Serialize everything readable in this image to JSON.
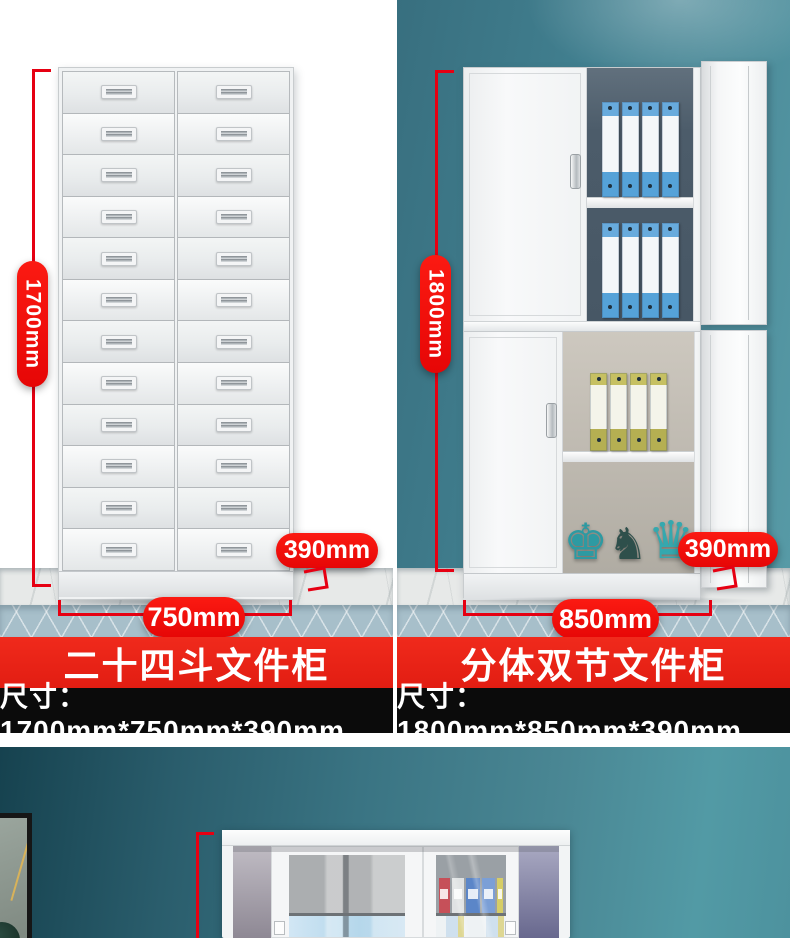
{
  "colors": {
    "accent_red": "#f2100e",
    "dimension_line_red": "#e60012",
    "banner_red": "#e8261a",
    "banner_black": "#0b0b0b",
    "wall_teal": "#417f8f",
    "floor_marble": "#e7e9e8",
    "carpet_blue": "#a7bfca",
    "cabinet_white": "#f5f6f7",
    "binder_blue": "#5fa8db",
    "binder_olive": "#c5bf63"
  },
  "products": [
    {
      "title": "二十四斗文件柜",
      "size_text": "尺寸：1700mm*750mm*390mm",
      "height_label": "1700mm",
      "width_label": "750mm",
      "depth_label": "390mm",
      "drawer_columns": 2,
      "drawer_rows": 12
    },
    {
      "title": "分体双节文件柜",
      "size_text": "尺寸：1800mm*850mm*390mm",
      "height_label": "1800mm",
      "width_label": "850mm",
      "depth_label": "390mm",
      "shelves": [
        {
          "binder_count": 4,
          "binder_color": "blue"
        },
        {
          "binder_count": 4,
          "binder_color": "blue"
        },
        {
          "binder_count": 4,
          "binder_color": "olive"
        }
      ],
      "chess_pieces": [
        {
          "name": "king",
          "glyph": "♚",
          "color": "#2d9aa2"
        },
        {
          "name": "knight",
          "glyph": "♞",
          "color": "#2e4f4b"
        },
        {
          "name": "queen",
          "glyph": "♛",
          "color": "#35a8ae"
        }
      ]
    }
  ]
}
